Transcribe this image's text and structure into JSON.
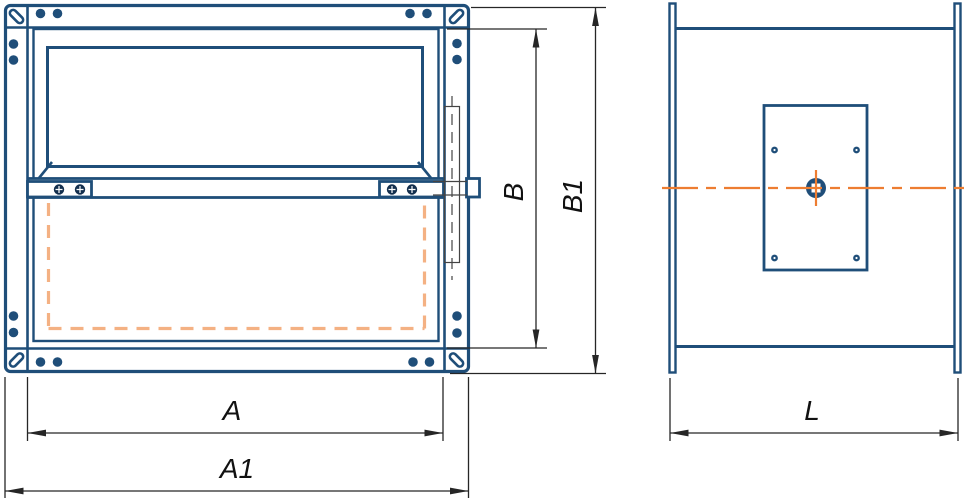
{
  "drawing": {
    "kind": "technical-drawing, damper/valve two-view dimensional drawing",
    "dimension_labels": {
      "a": "A",
      "a1": "A1",
      "b": "B",
      "b1": "B1",
      "l": "L"
    },
    "colors": {
      "drawing_blue": "#1F4E79",
      "screw_dark": "#132F4E",
      "dashed_tan": "#F4B183",
      "centerline_orange": "#ED7D31",
      "dimension_line": "#262626",
      "hidden_line": "#444444",
      "background": "#FFFFFF"
    }
  }
}
